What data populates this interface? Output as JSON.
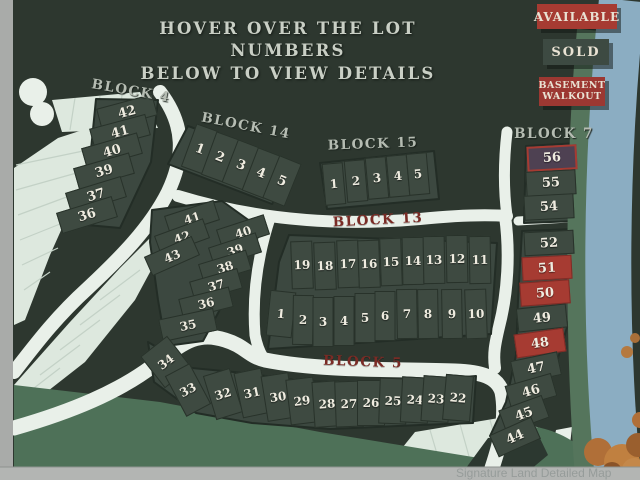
{
  "title": {
    "line1": "HOVER OVER THE LOT NUMBERS",
    "line2": "BELOW TO VIEW DETAILS"
  },
  "legend": {
    "available": {
      "label": "AVAILABLE",
      "color": "#a63b32"
    },
    "sold": {
      "label": "SOLD",
      "color": "#3d4a42"
    },
    "basement_walkout": {
      "label": "BASEMENT WALKOUT",
      "color": "#9c3832"
    }
  },
  "watermark": "Signature Land Detailed Map",
  "colors": {
    "background": "#2d372f",
    "lot_default": "#3e4a41",
    "lot_sold_red": "#a63b32",
    "lot_accent": "#4e4152",
    "road": "#e9f0e9",
    "open_space": "#dde8de",
    "greenbelt": "#4e7158",
    "water": "#8badc2",
    "label_light": "#b5bcb2",
    "label_maroon": "#7a2b25"
  },
  "blocks": [
    {
      "id": "b4",
      "label": "BLOCK 4",
      "lots": [
        {
          "n": "42"
        },
        {
          "n": "41"
        },
        {
          "n": "40"
        },
        {
          "n": "39"
        },
        {
          "n": "37"
        },
        {
          "n": "36"
        }
      ]
    },
    {
      "id": "b14",
      "label": "BLOCK 14",
      "lots": [
        {
          "n": "1"
        },
        {
          "n": "2"
        },
        {
          "n": "3"
        },
        {
          "n": "4"
        },
        {
          "n": "5"
        }
      ]
    },
    {
      "id": "b15",
      "label": "BLOCK 15",
      "lots": [
        {
          "n": "1"
        },
        {
          "n": "2"
        },
        {
          "n": "3"
        },
        {
          "n": "4"
        },
        {
          "n": "5"
        }
      ]
    },
    {
      "id": "b13",
      "label": "BLOCK 13",
      "lots": [
        {
          "n": "19"
        },
        {
          "n": "18"
        },
        {
          "n": "17"
        },
        {
          "n": "16"
        },
        {
          "n": "15"
        },
        {
          "n": "14"
        },
        {
          "n": "13"
        },
        {
          "n": "12"
        },
        {
          "n": "11"
        },
        {
          "n": "1"
        },
        {
          "n": "2"
        },
        {
          "n": "3"
        },
        {
          "n": "4"
        },
        {
          "n": "5"
        },
        {
          "n": "6"
        },
        {
          "n": "7"
        },
        {
          "n": "8"
        },
        {
          "n": "9"
        },
        {
          "n": "10"
        }
      ]
    },
    {
      "id": "b5u",
      "label": "",
      "lots": [
        {
          "n": "41"
        },
        {
          "n": "42"
        },
        {
          "n": "43"
        },
        {
          "n": "40"
        },
        {
          "n": "39"
        },
        {
          "n": "38"
        },
        {
          "n": "37"
        },
        {
          "n": "36"
        },
        {
          "n": "35"
        }
      ]
    },
    {
      "id": "b5",
      "label": "BLOCK 5",
      "lots": [
        {
          "n": "34"
        },
        {
          "n": "33"
        },
        {
          "n": "32"
        },
        {
          "n": "31"
        },
        {
          "n": "30"
        },
        {
          "n": "29"
        },
        {
          "n": "28"
        },
        {
          "n": "27"
        },
        {
          "n": "26"
        },
        {
          "n": "25"
        },
        {
          "n": "24"
        },
        {
          "n": "23"
        },
        {
          "n": "22"
        }
      ]
    },
    {
      "id": "b7",
      "label": "BLOCK 7",
      "lots": [
        {
          "n": "56",
          "v": "accent"
        },
        {
          "n": "55"
        },
        {
          "n": "54"
        },
        {
          "n": "52"
        },
        {
          "n": "51",
          "v": "red"
        },
        {
          "n": "50",
          "v": "red"
        },
        {
          "n": "49"
        },
        {
          "n": "48",
          "v": "red"
        },
        {
          "n": "47"
        },
        {
          "n": "46"
        },
        {
          "n": "45"
        },
        {
          "n": "44"
        }
      ]
    }
  ]
}
